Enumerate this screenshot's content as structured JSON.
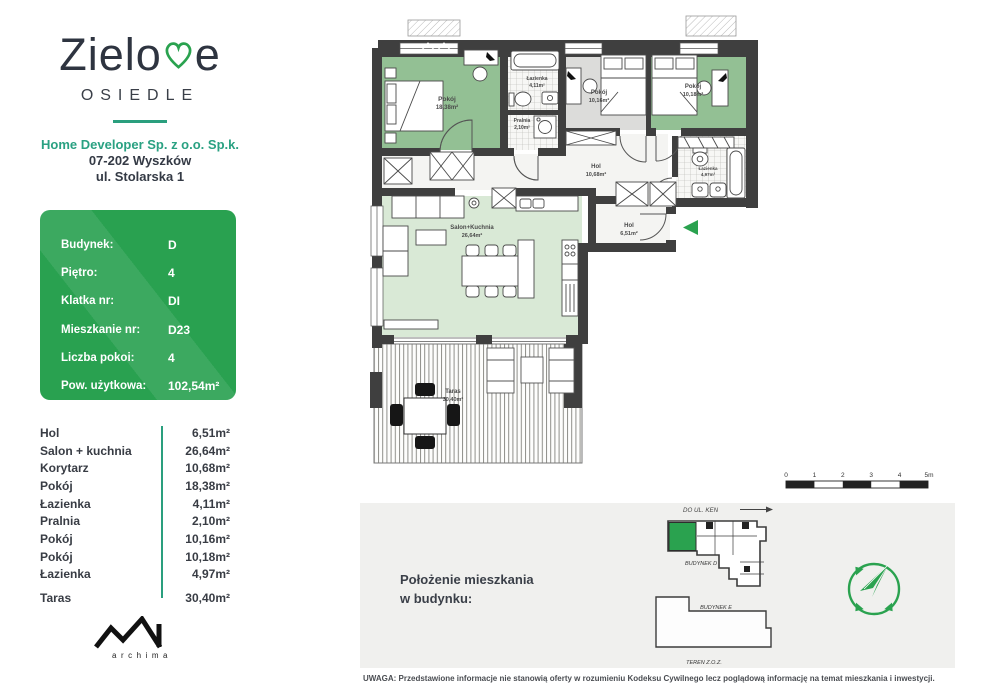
{
  "brand": {
    "pre": "Zielo",
    "post": "e",
    "sub": "OSIEDLE"
  },
  "developer": {
    "name": "Home Developer Sp. z o.o. Sp.k.",
    "line2": "07-202 Wyszków",
    "line3": "ul. Stolarska 1"
  },
  "info_card": {
    "rows": [
      {
        "label": "Budynek:",
        "value": "D"
      },
      {
        "label": "Piętro:",
        "value": "4"
      },
      {
        "label": "Klatka nr:",
        "value": "DI"
      },
      {
        "label": "Mieszkanie nr:",
        "value": "D23"
      },
      {
        "label": "Liczba pokoi:",
        "value": "4"
      },
      {
        "label": "Pow. użytkowa:",
        "value": "102,54m²"
      }
    ]
  },
  "room_table": {
    "rows": [
      {
        "name": "Hol",
        "area": "6,51m²"
      },
      {
        "name": "Salon + kuchnia",
        "area": "26,64m²"
      },
      {
        "name": "Korytarz",
        "area": "10,68m²"
      },
      {
        "name": "Pokój",
        "area": "18,38m²"
      },
      {
        "name": "Łazienka",
        "area": "4,11m²"
      },
      {
        "name": "Pralnia",
        "area": "2,10m²"
      },
      {
        "name": "Pokój",
        "area": "10,16m²"
      },
      {
        "name": "Pokój",
        "area": "10,18m²"
      },
      {
        "name": "Łazienka",
        "area": "4,97m²"
      },
      {
        "name": "Taras",
        "area": "30,40m²"
      }
    ]
  },
  "plan": {
    "rooms": [
      {
        "name": "Pokój",
        "area": "18,38m²"
      },
      {
        "name": "Łazienka",
        "area": "4,11m²"
      },
      {
        "name": "Pralnia",
        "area": "2,10m²"
      },
      {
        "name": "Pokój",
        "area": "10,16m²"
      },
      {
        "name": "Pokój",
        "area": "10,18m²"
      },
      {
        "name": "Hol",
        "area": "10,68m²"
      },
      {
        "name": "Hol",
        "area": "6,51m²"
      },
      {
        "name": "Łazienka",
        "area": "4,97m²"
      },
      {
        "name": "Salon+Kuchnia",
        "area": "26,64m²"
      },
      {
        "name": "Taras",
        "area": "30,40m²"
      }
    ]
  },
  "scale": {
    "ticks": [
      "0",
      "1",
      "2",
      "3",
      "4",
      "5m"
    ]
  },
  "location": {
    "heading1": "Położenie mieszkania",
    "heading2": "w budynku:",
    "direction": "DO UL. KEN",
    "building_d": "BUDYNEK D",
    "building_e": "BUDYNEK E",
    "teren": "TEREN Z.O.Z."
  },
  "archima": {
    "letters": "archima"
  },
  "disclaimer": {
    "text": "UWAGA: Przedstawione informacje nie stanowią oferty w rozumieniu Kodeksu Cywilnego lecz poglądową informację na temat mieszkania i inwestycji."
  },
  "colors": {
    "accent_teal": "#2a9f7e",
    "card_green": "#29a150",
    "plan_green": "#93c094",
    "plan_light_green": "#d9e9d6",
    "arrow_green": "#2aa24f"
  }
}
